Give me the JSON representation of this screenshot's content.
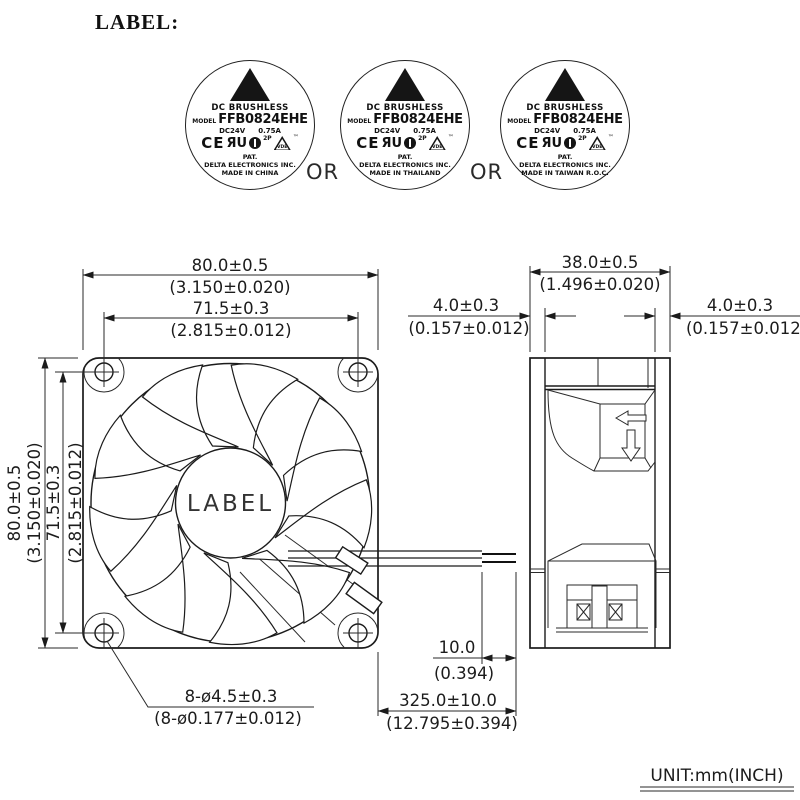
{
  "header": {
    "title": "LABEL:"
  },
  "connector": {
    "or": "OR"
  },
  "labels": [
    {
      "type": "DC BRUSHLESS",
      "model_label": "MODEL",
      "model": "FFB0824EHE",
      "voltage": "DC24V",
      "current": "0.75A",
      "cert_ce": "CE",
      "cert_ul": "ЯU",
      "cert_class": "2P",
      "cert_vde": "VDE",
      "cert_tm": "™",
      "pat": "PAT.",
      "company": "DELTA ELECTRONICS INC.",
      "origin": "MADE IN CHINA"
    },
    {
      "type": "DC BRUSHLESS",
      "model_label": "MODEL",
      "model": "FFB0824EHE",
      "voltage": "DC24V",
      "current": "0.75A",
      "cert_ce": "CE",
      "cert_ul": "ЯU",
      "cert_class": "2P",
      "cert_vde": "VDE",
      "cert_tm": "™",
      "pat": "PAT.",
      "company": "DELTA ELECTRONICS INC.",
      "origin": "MADE IN THAILAND"
    },
    {
      "type": "DC BRUSHLESS",
      "model_label": "MODEL",
      "model": "FFB0824EHE",
      "voltage": "DC24V",
      "current": "0.75A",
      "cert_ce": "CE",
      "cert_ul": "ЯU",
      "cert_class": "2P",
      "cert_vde": "VDE",
      "cert_tm": "™",
      "pat": "PAT.",
      "company": "DELTA ELECTRONICS INC.",
      "origin": "MADE IN TAIWAN R.O.C."
    }
  ],
  "fan": {
    "hub_label": "LABEL"
  },
  "dims": {
    "front_width_mm": "80.0±0.5",
    "front_width_in": "(3.150±0.020)",
    "front_holes_mm": "71.5±0.3",
    "front_holes_in": "(2.815±0.012)",
    "front_height_mm": "80.0±0.5",
    "front_height_in": "(3.150±0.020)",
    "front_holes_v_mm": "71.5±0.3",
    "front_holes_v_in": "(2.815±0.012)",
    "depth_mm": "38.0±0.5",
    "depth_in": "(1.496±0.020)",
    "flange_l_mm": "4.0±0.3",
    "flange_l_in": "(0.157±0.012)",
    "flange_r_mm": "4.0±0.3",
    "flange_r_in": "(0.157±0.012)",
    "mount_holes_mm": "8-ø4.5±0.3",
    "mount_holes_in": "(8-ø0.177±0.012)",
    "strip_len_mm": "10.0",
    "strip_len_in": "(0.394)",
    "lead_len_mm": "325.0±10.0",
    "lead_len_in": "(12.795±0.394)"
  },
  "footer": {
    "unit": "UNIT:mm(INCH)"
  }
}
